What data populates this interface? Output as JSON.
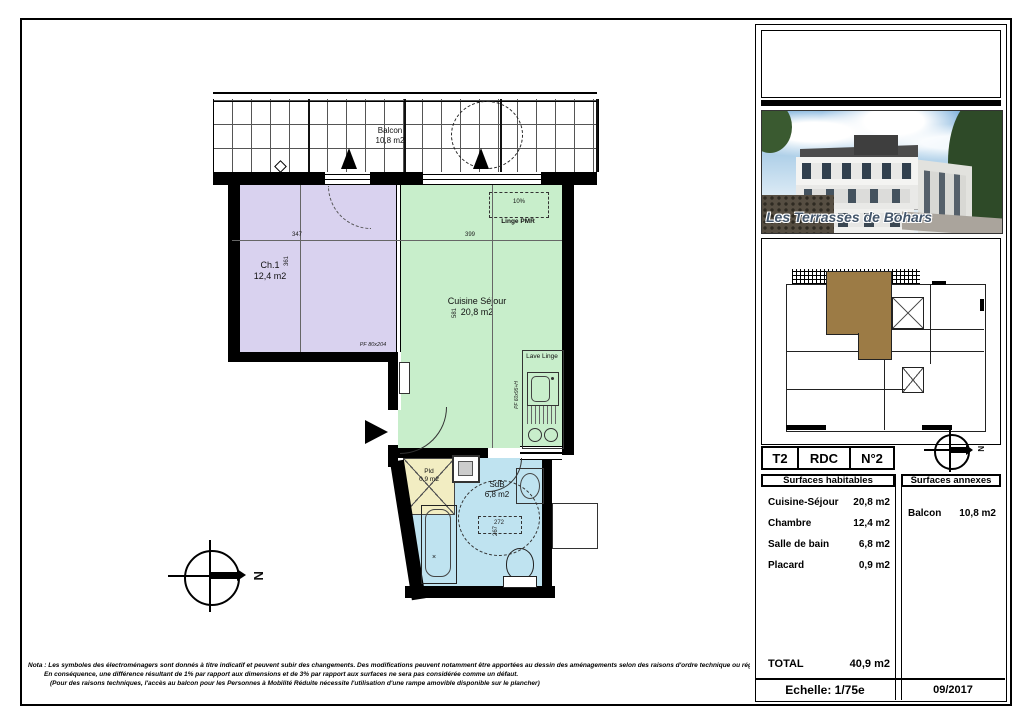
{
  "page": {
    "note_line1": "Nota : Les symboles des électroménagers sont donnés à titre indicatif et peuvent subir des changements. Des modifications peuvent notamment être apportées au dessin des aménagements selon des raisons d'ordre technique ou réglementaire pouvant être apportées sur les plans.",
    "note_line2": "En conséquence, une différence résultant de 1% par rapport aux dimensions et de 3% par rapport aux surfaces ne sera pas considérée comme un défaut.",
    "note_line3": "(Pour des raisons techniques, l'accès au balcon pour les Personnes à Mobilité Réduite nécessite l'utilisation d'une rampe amovible disponible sur le plancher)"
  },
  "plan": {
    "north_label": "N",
    "rooms": {
      "balcon": {
        "name": "Balcon",
        "area": "10,8 m2"
      },
      "chambre": {
        "name": "Ch.1",
        "area": "12,4 m2"
      },
      "sejour": {
        "name": "Cuisine Séjour",
        "area": "20,8 m2"
      },
      "sdb": {
        "name": "SdB",
        "area": "6,8 m2"
      },
      "placard": {
        "name": "Pld",
        "area": "0,9 m2"
      }
    },
    "annotations": {
      "lave_linge": "Lave Linge",
      "slope": "10%",
      "linge_pmr": "Linge PMR",
      "door_label": "PF 80x204",
      "window_label": "PF 60x95+H"
    },
    "dimensions": {
      "ch1_width": "347",
      "ch1_height": "361",
      "sejour_width": "399",
      "sejour_height": "581",
      "sdb_width": "272",
      "sdb_height": "267"
    }
  },
  "sidebar": {
    "photo_caption": "Les Terrasses de Bohars",
    "unit": {
      "type": "T2",
      "floor": "RDC",
      "number": "N°2"
    },
    "habitables": {
      "header": "Surfaces habitables",
      "rows": [
        {
          "label": "Cuisine-Séjour",
          "value": "20,8 m2"
        },
        {
          "label": "Chambre",
          "value": "12,4 m2"
        },
        {
          "label": "Salle de bain",
          "value": "6,8 m2"
        },
        {
          "label": "Placard",
          "value": "0,9 m2"
        }
      ],
      "total_label": "TOTAL",
      "total_value": "40,9 m2"
    },
    "annexes": {
      "header": "Surfaces annexes",
      "rows": [
        {
          "label": "Balcon",
          "value": "10,8 m2"
        }
      ]
    },
    "footer": {
      "scale": "Echelle: 1/75e",
      "date": "09/2017"
    }
  },
  "colors": {
    "chambre": "#d9d2ef",
    "sejour": "#c8eecb",
    "sdb": "#bfe3f0",
    "placard": "#f2edc2",
    "unit_highlight": "#9c7b45"
  }
}
